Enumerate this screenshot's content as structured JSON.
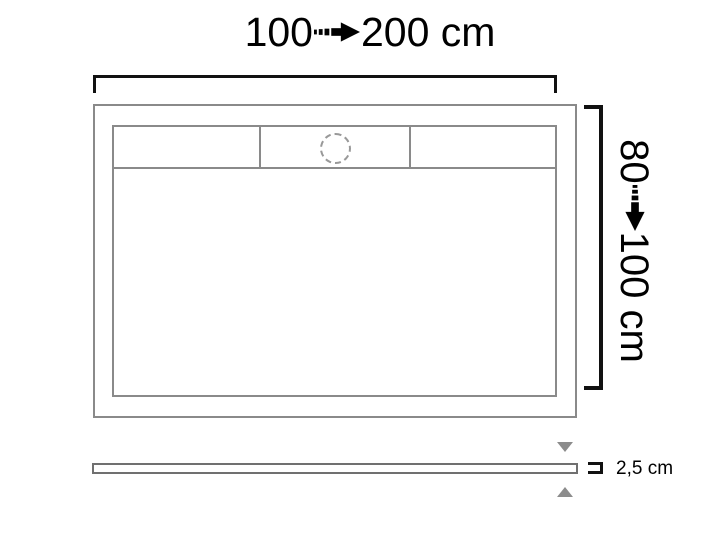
{
  "diagram": {
    "type": "shower-tray-dimension-drawing",
    "background": "#ffffff",
    "colors": {
      "outline": "#8a8a8a",
      "dimension_marks": "#111111",
      "spacer_triangles": "#8c8c8c",
      "drain_dashed": "#999999",
      "text": "#000000"
    },
    "top_dimension": {
      "from": "100",
      "to": "200 cm"
    },
    "side_dimension": {
      "from": "80",
      "to": "100 cm"
    },
    "thickness_dimension": {
      "value": "2,5 cm"
    },
    "icons": {
      "range_arrow": "striped-right-arrow",
      "above_bar": "triangle-down",
      "below_bar": "triangle-up",
      "thickness_bracket": "open-left-bracket"
    }
  }
}
